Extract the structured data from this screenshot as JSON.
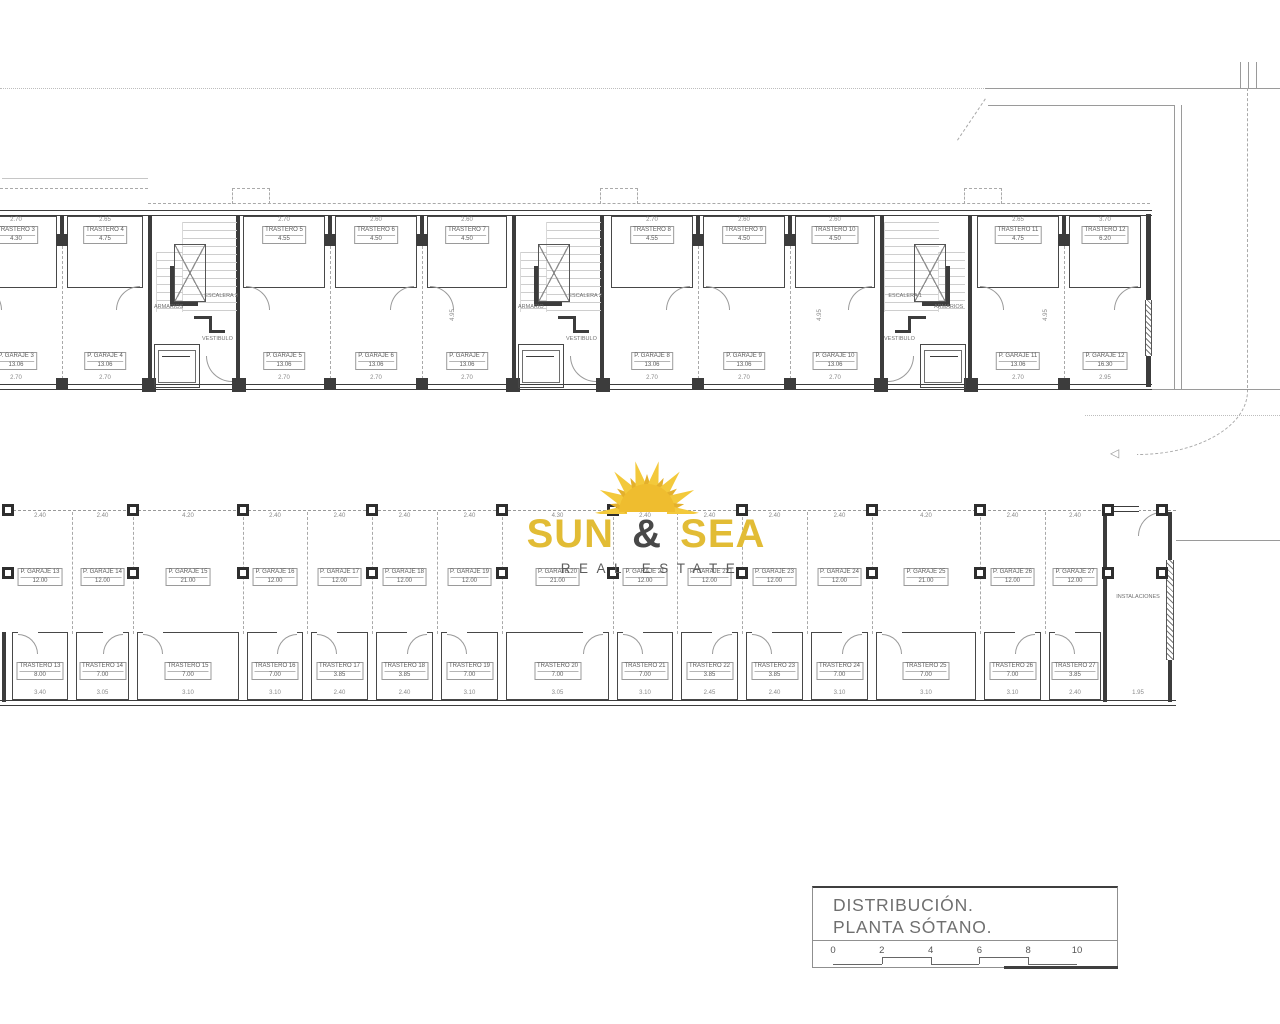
{
  "brand": {
    "word1": "SUN",
    "amp": "&",
    "word2": "SEA",
    "subtitle": "REAL ESTATE",
    "gold": "#E2BC35",
    "dark": "#484848"
  },
  "title_block": {
    "line1": "DISTRIBUCIÓN.",
    "line2": "PLANTA SÓTANO.",
    "scale_ticks": [
      "0",
      "2",
      "4",
      "6",
      "8",
      "10"
    ]
  },
  "top_strip": {
    "stair_cores": [
      {
        "label": "ESCALERA 3",
        "closet_label": "ARMARIOS",
        "hall_label": "VESTIBULO",
        "x": 148,
        "mirrored": false
      },
      {
        "label": "ESCALERA 2",
        "closet_label": "ARMARIO",
        "hall_label": "VESTIBULO",
        "x": 512,
        "mirrored": false
      },
      {
        "label": "ESCALERA 1",
        "closet_label": "ARMARIOS",
        "hall_label": "VESTIBULO",
        "x": 880,
        "mirrored": true
      }
    ],
    "bays": [
      {
        "trastero": "TRASTERO 3",
        "t_area": "4.30",
        "garaje": "P. GARAJE 3",
        "g_area": "13.06",
        "x1": -30,
        "x2": 62,
        "dim_top": "2.70",
        "dim_bot": "2.70"
      },
      {
        "trastero": "TRASTERO 4",
        "t_area": "4.75",
        "garaje": "P. GARAJE 4",
        "g_area": "13.06",
        "x1": 62,
        "x2": 148,
        "dim_top": "2.65",
        "dim_bot": "2.70"
      },
      {
        "trastero": "TRASTERO 5",
        "t_area": "4.55",
        "garaje": "P. GARAJE 5",
        "g_area": "13.06",
        "x1": 238,
        "x2": 330,
        "dim_top": "2.70",
        "dim_bot": "2.70"
      },
      {
        "trastero": "TRASTERO 6",
        "t_area": "4.50",
        "garaje": "P. GARAJE 6",
        "g_area": "13.06",
        "x1": 330,
        "x2": 422,
        "dim_top": "2.60",
        "dim_bot": "2.70"
      },
      {
        "trastero": "TRASTERO 7",
        "t_area": "4.50",
        "garaje": "P. GARAJE 7",
        "g_area": "13.06",
        "x1": 422,
        "x2": 512,
        "dim_top": "2.60",
        "dim_bot": "2.70"
      },
      {
        "trastero": "TRASTERO 8",
        "t_area": "4.55",
        "garaje": "P. GARAJE 8",
        "g_area": "13.06",
        "x1": 606,
        "x2": 698,
        "dim_top": "2.70",
        "dim_bot": "2.70"
      },
      {
        "trastero": "TRASTERO 9",
        "t_area": "4.50",
        "garaje": "P. GARAJE 9",
        "g_area": "13.06",
        "x1": 698,
        "x2": 790,
        "dim_top": "2.60",
        "dim_bot": "2.70"
      },
      {
        "trastero": "TRASTERO 10",
        "t_area": "4.50",
        "garaje": "P. GARAJE 10",
        "g_area": "13.06",
        "x1": 790,
        "x2": 880,
        "dim_top": "2.60",
        "dim_bot": "2.70"
      },
      {
        "trastero": "TRASTERO 11",
        "t_area": "4.75",
        "garaje": "P. GARAJE 11",
        "g_area": "13.06",
        "x1": 972,
        "x2": 1064,
        "dim_top": "2.65",
        "dim_bot": "2.70"
      },
      {
        "trastero": "TRASTERO 12",
        "t_area": "6.20",
        "garaje": "P. GARAJE 12",
        "g_area": "16.30",
        "x1": 1064,
        "x2": 1146,
        "dim_top": "3.70",
        "dim_bot": "2.95"
      }
    ],
    "inner_boundaries": [
      62,
      330,
      422,
      698,
      790,
      1064
    ],
    "dims_vertical": [
      {
        "text": "4.95",
        "x": 447,
        "y": 312
      },
      {
        "text": "4.95",
        "x": 814,
        "y": 312
      },
      {
        "text": "4.95",
        "x": 1040,
        "y": 312
      }
    ]
  },
  "bottom_strip": {
    "bays": [
      {
        "g": "P. GARAJE 13",
        "ga": "12.00",
        "t": "TRASTERO 13",
        "ta": "8.00",
        "x1": 8,
        "x2": 72,
        "dt": "2.40",
        "db": "3.40"
      },
      {
        "g": "P. GARAJE 14",
        "ga": "12.00",
        "t": "TRASTERO 14",
        "ta": "7.00",
        "x1": 72,
        "x2": 133,
        "dt": "2.40",
        "db": "3.05"
      },
      {
        "g": "P. GARAJE 15",
        "ga": "21.00",
        "t": "TRASTERO 15",
        "ta": "7.00",
        "x1": 133,
        "x2": 243,
        "dt": "4.20",
        "db": "3.10"
      },
      {
        "g": "P. GARAJE 16",
        "ga": "12.00",
        "t": "TRASTERO 16",
        "ta": "7.00",
        "x1": 243,
        "x2": 307,
        "dt": "2.40",
        "db": "3.10"
      },
      {
        "g": "P. GARAJE 17",
        "ga": "12.00",
        "t": "TRASTERO 17",
        "ta": "3.85",
        "x1": 307,
        "x2": 372,
        "dt": "2.40",
        "db": "2.40"
      },
      {
        "g": "P. GARAJE 18",
        "ga": "12.00",
        "t": "TRASTERO 18",
        "ta": "3.85",
        "x1": 372,
        "x2": 437,
        "dt": "2.40",
        "db": "2.40"
      },
      {
        "g": "P. GARAJE 19",
        "ga": "12.00",
        "t": "TRASTERO 19",
        "ta": "7.00",
        "x1": 437,
        "x2": 502,
        "dt": "2.40",
        "db": "3.10"
      },
      {
        "g": "P. GARAJE 20",
        "ga": "21.00",
        "t": "TRASTERO 20",
        "ta": "7.00",
        "x1": 502,
        "x2": 613,
        "dt": "4.30",
        "db": "3.05"
      },
      {
        "g": "P. GARAJE 21",
        "ga": "12.00",
        "t": "TRASTERO 21",
        "ta": "7.00",
        "x1": 613,
        "x2": 677,
        "dt": "2.40",
        "db": "3.10"
      },
      {
        "g": "P. GARAJE 22",
        "ga": "12.00",
        "t": "TRASTERO 22",
        "ta": "3.85",
        "x1": 677,
        "x2": 742,
        "dt": "2.40",
        "db": "2.45"
      },
      {
        "g": "P. GARAJE 23",
        "ga": "12.00",
        "t": "TRASTERO 23",
        "ta": "3.85",
        "x1": 742,
        "x2": 807,
        "dt": "2.40",
        "db": "2.40"
      },
      {
        "g": "P. GARAJE 24",
        "ga": "12.00",
        "t": "TRASTERO 24",
        "ta": "7.00",
        "x1": 807,
        "x2": 872,
        "dt": "2.40",
        "db": "3.10"
      },
      {
        "g": "P. GARAJE 25",
        "ga": "21.00",
        "t": "TRASTERO 25",
        "ta": "7.00",
        "x1": 872,
        "x2": 980,
        "dt": "4.20",
        "db": "3.10"
      },
      {
        "g": "P. GARAJE 26",
        "ga": "12.00",
        "t": "TRASTERO 26",
        "ta": "7.00",
        "x1": 980,
        "x2": 1045,
        "dt": "2.40",
        "db": "3.10"
      },
      {
        "g": "P. GARAJE 27",
        "ga": "12.00",
        "t": "TRASTERO 27",
        "ta": "3.85",
        "x1": 1045,
        "x2": 1105,
        "dt": "2.40",
        "db": "2.40"
      }
    ],
    "room_label": "INSTALACIONES",
    "room_dim": "1.95",
    "columns_top_x": [
      8,
      133,
      243,
      372,
      502,
      613,
      742,
      872,
      980,
      1108,
      1162
    ],
    "columns_mid_x": [
      8,
      133,
      243,
      372,
      502,
      613,
      742,
      872,
      980,
      1108,
      1162
    ]
  }
}
